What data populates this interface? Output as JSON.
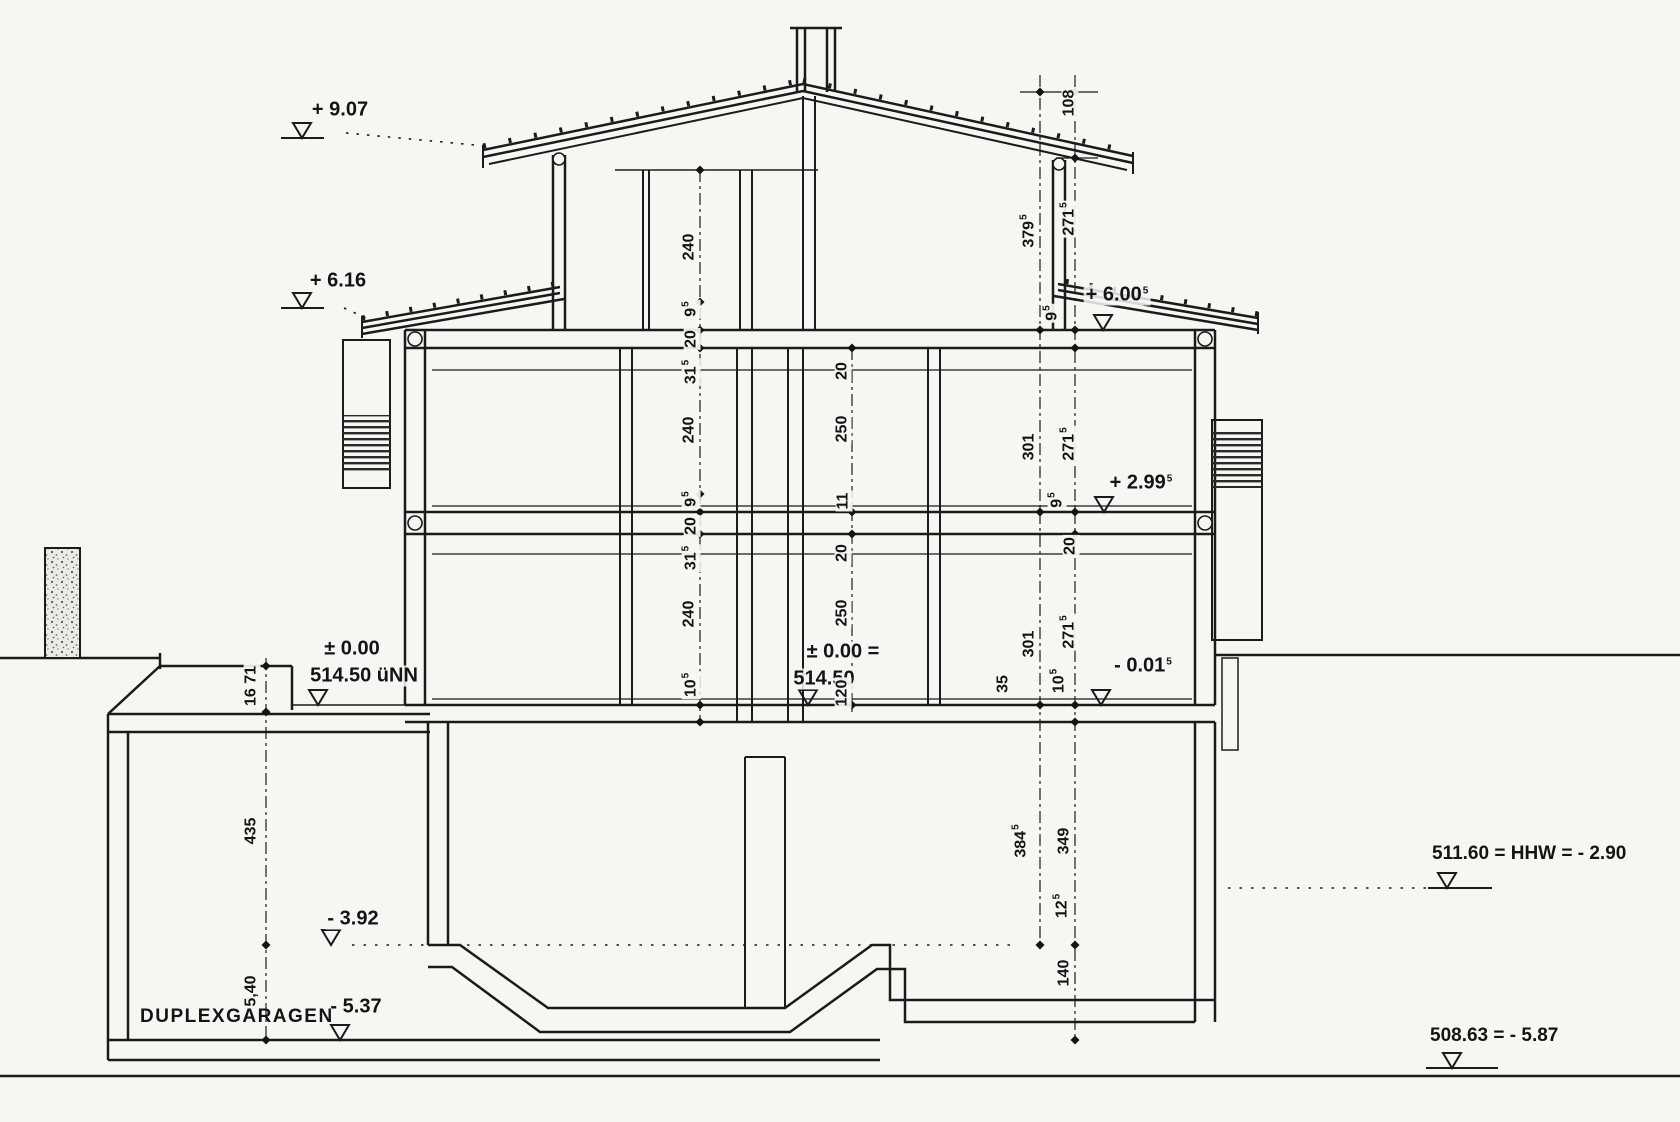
{
  "drawing": {
    "garage_label": "DUPLEXGARAGEN",
    "note_hhw": "511.60 = HHW = - 2.90",
    "note_bottom": "508.63 = - 5.87",
    "datum_text": "514.50 üNN",
    "colors": {
      "ink": "#1b1b1b",
      "paper": "#f7f6f3"
    }
  },
  "labels": [
    {
      "n": "level-label-9-07",
      "t": "+ 9.07",
      "x": 340,
      "y": 110,
      "lv": true
    },
    {
      "n": "level-label-6-16",
      "t": "+ 6.16",
      "x": 338,
      "y": 281,
      "lv": true
    },
    {
      "n": "level-label-zero-left",
      "t": "± 0.00",
      "x": 352,
      "y": 649,
      "lv": true
    },
    {
      "n": "datum-label-left",
      "t": "514.50 üNN",
      "x": 364,
      "y": 676,
      "lv": true
    },
    {
      "n": "level-label-zero-center",
      "t": "± 0.00 =",
      "x": 843,
      "y": 652,
      "lv": true
    },
    {
      "n": "datum-label-center",
      "t": "514.50",
      "x": 824,
      "y": 679,
      "lv": true
    },
    {
      "n": "level-label-2-99",
      "t": "+ 2.99",
      "s": "5",
      "x": 1141,
      "y": 483,
      "lv": true
    },
    {
      "n": "level-label-0-01",
      "t": "- 0.01",
      "s": "5",
      "x": 1143,
      "y": 666,
      "lv": true
    },
    {
      "n": "level-label-6-00",
      "t": "+ 6.00",
      "s": "5",
      "x": 1117,
      "y": 295,
      "lv": true
    },
    {
      "n": "level-label-3-92",
      "t": "- 3.92",
      "x": 353,
      "y": 919,
      "lv": true
    },
    {
      "n": "level-label-5-37",
      "t": "- 5.37",
      "x": 356,
      "y": 1007,
      "lv": true
    },
    {
      "n": "dim-label-240-a",
      "t": "240",
      "x": 690,
      "y": 247,
      "r": 1
    },
    {
      "n": "dim-label-95-a",
      "t": "9",
      "s": "5",
      "x": 691,
      "y": 309,
      "r": 1
    },
    {
      "n": "dim-label-20-a",
      "t": "20",
      "x": 692,
      "y": 339,
      "r": 1
    },
    {
      "n": "dim-label-315-a",
      "t": "31",
      "s": "5",
      "x": 691,
      "y": 372,
      "r": 1
    },
    {
      "n": "dim-label-240-b",
      "t": "240",
      "x": 690,
      "y": 430,
      "r": 1
    },
    {
      "n": "dim-label-95-b",
      "t": "9",
      "s": "5",
      "x": 691,
      "y": 499,
      "r": 1
    },
    {
      "n": "dim-label-20-b",
      "t": "20",
      "x": 692,
      "y": 526,
      "r": 1
    },
    {
      "n": "dim-label-315-b",
      "t": "31",
      "s": "5",
      "x": 691,
      "y": 558,
      "r": 1
    },
    {
      "n": "dim-label-240-c",
      "t": "240",
      "x": 690,
      "y": 614,
      "r": 1
    },
    {
      "n": "dim-label-105-a",
      "t": "10",
      "s": "5",
      "x": 691,
      "y": 685,
      "r": 1
    },
    {
      "n": "dim-label-20-c",
      "t": "20",
      "x": 843,
      "y": 371,
      "r": 1
    },
    {
      "n": "dim-label-250-a",
      "t": "250",
      "x": 843,
      "y": 429,
      "r": 1
    },
    {
      "n": "dim-label-11",
      "t": "11",
      "x": 844,
      "y": 501,
      "r": 1
    },
    {
      "n": "dim-label-20-d",
      "t": "20",
      "x": 843,
      "y": 553,
      "r": 1
    },
    {
      "n": "dim-label-250-b",
      "t": "250",
      "x": 843,
      "y": 613,
      "r": 1
    },
    {
      "n": "dim-label-120",
      "t": "120",
      "x": 843,
      "y": 693,
      "r": 1
    },
    {
      "n": "dim-label-3795",
      "t": "379",
      "s": "5",
      "x": 1029,
      "y": 231,
      "r": 1
    },
    {
      "n": "dim-label-301-a",
      "t": "301",
      "x": 1030,
      "y": 447,
      "r": 1
    },
    {
      "n": "dim-label-301-b",
      "t": "301",
      "x": 1030,
      "y": 644,
      "r": 1
    },
    {
      "n": "dim-label-108",
      "t": "108",
      "x": 1070,
      "y": 103,
      "r": 1
    },
    {
      "n": "dim-label-2715-a",
      "t": "271",
      "s": "5",
      "x": 1069,
      "y": 219,
      "r": 1
    },
    {
      "n": "dim-label-95-c",
      "t": "9",
      "s": "5",
      "x": 1052,
      "y": 313,
      "r": 1
    },
    {
      "n": "dim-label-2715-b",
      "t": "271",
      "s": "5",
      "x": 1069,
      "y": 444,
      "r": 1
    },
    {
      "n": "dim-label-95-d",
      "t": "9",
      "s": "5",
      "x": 1057,
      "y": 500,
      "r": 1
    },
    {
      "n": "dim-label-20-e",
      "t": "20",
      "x": 1071,
      "y": 546,
      "r": 1
    },
    {
      "n": "dim-label-2715-c",
      "t": "271",
      "s": "5",
      "x": 1069,
      "y": 632,
      "r": 1
    },
    {
      "n": "dim-label-105-b",
      "t": "10",
      "s": "5",
      "x": 1059,
      "y": 681,
      "r": 1
    },
    {
      "n": "dim-label-35",
      "t": "35",
      "x": 1004,
      "y": 684,
      "r": 1
    },
    {
      "n": "dim-label-3845",
      "t": "384",
      "s": "5",
      "x": 1021,
      "y": 841,
      "r": 1
    },
    {
      "n": "dim-label-349",
      "t": "349",
      "x": 1065,
      "y": 841,
      "r": 1
    },
    {
      "n": "dim-label-125",
      "t": "12",
      "s": "5",
      "x": 1062,
      "y": 906,
      "r": 1
    },
    {
      "n": "dim-label-140",
      "t": "140",
      "x": 1065,
      "y": 973,
      "r": 1
    },
    {
      "n": "dim-label-16-71",
      "t": "16 71",
      "x": 252,
      "y": 686,
      "r": 1
    },
    {
      "n": "dim-label-435",
      "t": "435",
      "x": 252,
      "y": 831,
      "r": 1
    },
    {
      "n": "dim-label-540",
      "t": "5,40",
      "x": 252,
      "y": 991,
      "r": 1
    }
  ]
}
